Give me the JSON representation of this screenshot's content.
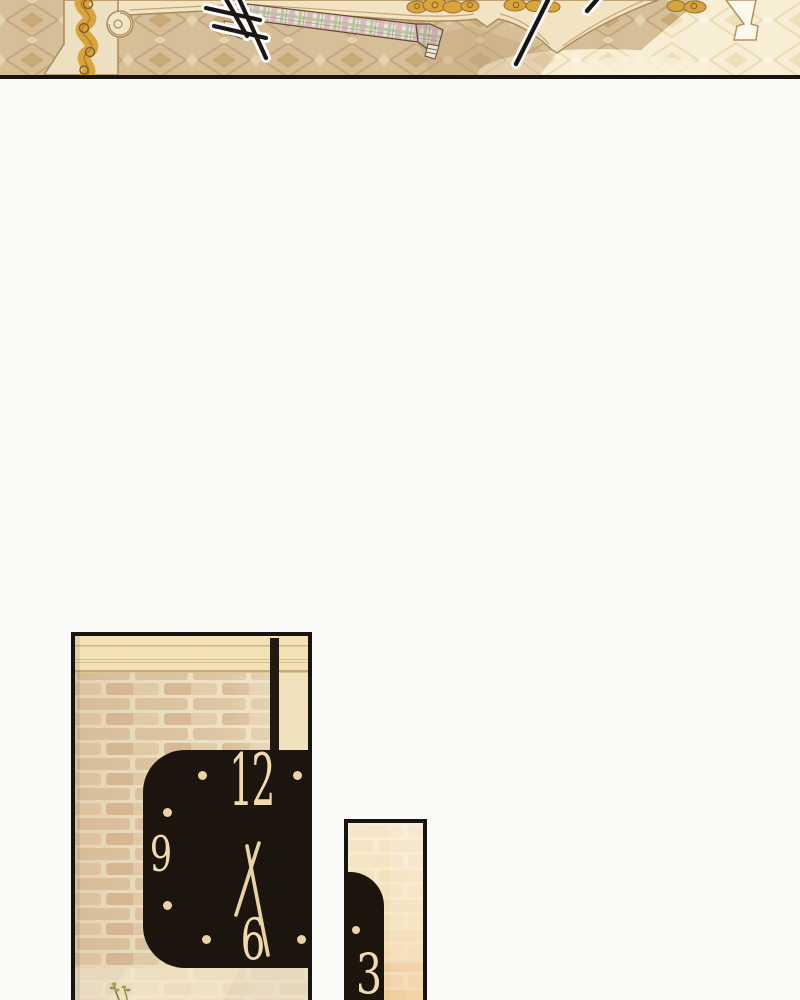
{
  "comic": {
    "border_color": "#14100d",
    "paper_color": "#fcfcfa"
  },
  "bedroom_panel": {
    "carpet_color": "#d6bf97",
    "carpet_motif_color": "#c6a77a",
    "bed_color": "#f3e5c3",
    "gold_trim_color": "#d9a33b",
    "sunlight_color": "#f8efd6",
    "plaid": {
      "base": "#ece6d4",
      "pink": "#dcb3c0",
      "green": "#b7c2a2"
    },
    "action_stroke_color": "#151210"
  },
  "large_clock_panel": {
    "numerals": {
      "twelve": "12",
      "nine": "9",
      "six": "6"
    },
    "face_color": "#17110a",
    "numeral_color": "#f1dbae",
    "brick_color": "#dcc2a0",
    "mortar_color": "#eee2c6",
    "molding_color": "#f3e3b6"
  },
  "small_clock_panel": {
    "numerals": {
      "three": "3"
    },
    "face_color": "#17110a",
    "numeral_color": "#f1dbae",
    "wall_top_color": "#f9efd9",
    "wall_bottom_color": "#f3d6a6"
  }
}
